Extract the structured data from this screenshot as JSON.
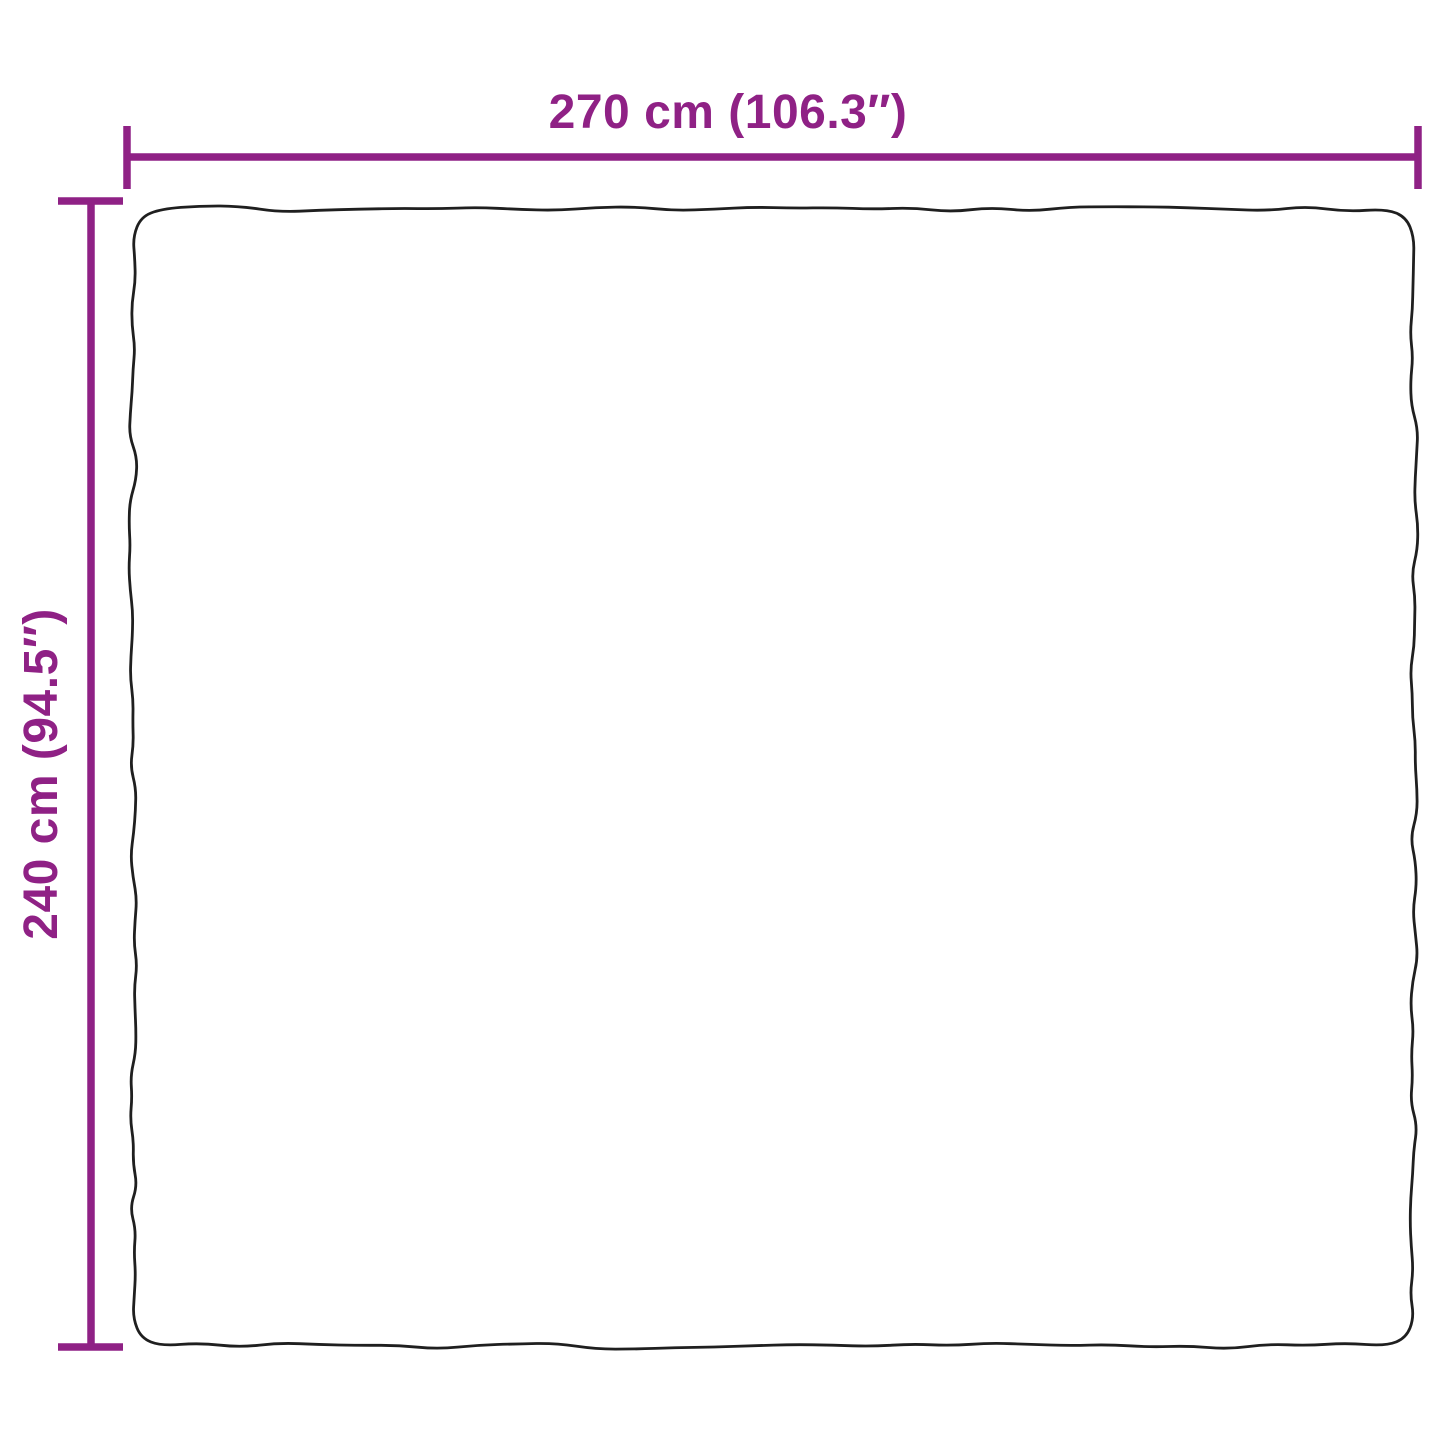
{
  "diagram": {
    "type": "product-dimension-diagram",
    "width_label": "270 cm (106.3″)",
    "height_label": "240 cm (94.5″)",
    "accent_color": "#8F2185",
    "outline_color": "#1f1f1f",
    "background_color": "#ffffff"
  }
}
